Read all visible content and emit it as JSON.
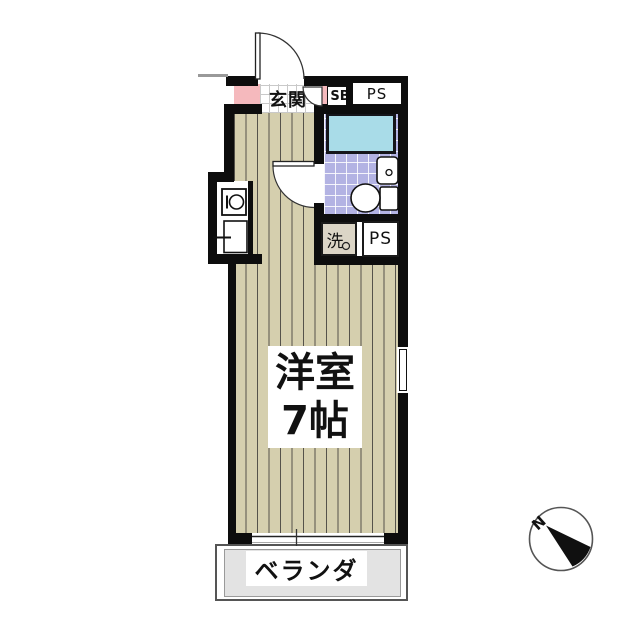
{
  "title": "one-room apartment floor plan",
  "labels": {
    "entrance": "玄関",
    "shoe_box": "SB",
    "pipe_space_top": "PS",
    "washer": "洗",
    "pipe_space_mid": "PS",
    "room_name": "洋室",
    "room_size": "7帖",
    "balcony": "ベランダ",
    "compass_north": "N"
  },
  "colors": {
    "wall": "#0d0d0d",
    "accent-pink": "#f5b9bd",
    "tub-cyan": "#a9dce8",
    "bath-tile": "#b3b3e3",
    "wood-floor": "#d5cfae",
    "wood-line": "#55524a",
    "balcony-gray": "#e3e3e3",
    "tile-grid": "#c9c9c9"
  }
}
